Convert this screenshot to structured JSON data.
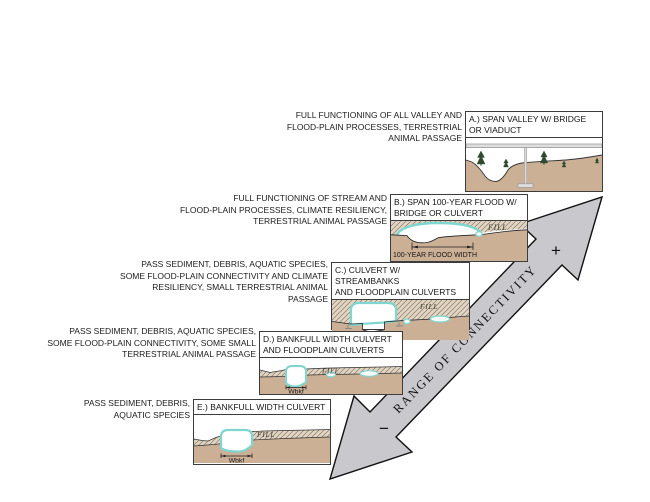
{
  "arrow": {
    "label": "RANGE OF CONNECTIVITY",
    "plus_label": "+",
    "minus_label": "−"
  },
  "steps": [
    {
      "id": "A",
      "description": "FULL FUNCTIONING OF ALL VALLEY AND\nFLOOD-PLAIN PROCESSES, TERRESTRIAL\nANIMAL PASSAGE",
      "title": "A.) SPAN VALLEY W/ BRIDGE\nOR VIADUCT"
    },
    {
      "id": "B",
      "description": "FULL FUNCTIONING OF STREAM AND\nFLOOD-PLAIN PROCESSES, CLIMATE RESILIENCY,\nTERRESTRIAL ANIMAL PASSAGE",
      "title": "B.) SPAN 100-YEAR FLOOD W/\nBRIDGE OR CULVERT",
      "fill_label": "FILL",
      "flood_width_label": "100-YEAR FLOOD WIDTH"
    },
    {
      "id": "C",
      "description": "PASS SEDIMENT, DEBRIS, AQUATIC SPECIES,\nSOME FLOOD-PLAIN CONNECTIVITY AND CLIMATE\nRESILIENCY, SMALL TERRESTRIAL ANIMAL\nPASSAGE",
      "title": "C.) CULVERT W/ STREAMBANKS\nAND FLOODPLAIN CULVERTS",
      "fill_label": "FILL",
      "bankfull_width_label": "Wbkf"
    },
    {
      "id": "D",
      "description": "PASS SEDIMENT, DEBRIS, AQUATIC SPECIES,\nSOME FLOOD-PLAIN CONNECTIVITY, SOME SMALL\nTERRESTRIAL ANIMAL PASSAGE",
      "title": "D.) BANKFULL WIDTH CULVERT\nAND FLOODPLAIN CULVERTS",
      "fill_label": "FILL",
      "bankfull_width_label": "Wbkf"
    },
    {
      "id": "E",
      "description": "PASS SEDIMENT, DEBRIS,\nAQUATIC SPECIES",
      "title": "E.) BANKFULL WIDTH CULVERT",
      "fill_label": "FILL",
      "bankfull_width_label": "Wbkf"
    }
  ],
  "colors": {
    "terrain": "#cbb096",
    "hatch_background": "#e1d5c3",
    "hatch_line": "#8b7a68",
    "water_outline": "#7fd6d0",
    "arrow_fill": "#c9c9cd",
    "tree": "#2e4b2e",
    "bridge_gray": "#dedede"
  }
}
